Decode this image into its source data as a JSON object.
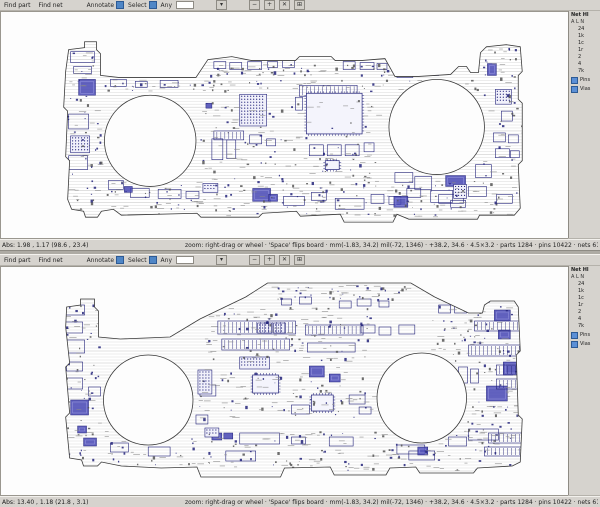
{
  "colors": {
    "toolbar_bg": "#d6d3ce",
    "canvas_bg": "#fdfdfd",
    "accent_blue": "#4f86c6",
    "component_navy": "#23237a",
    "component_fill": "#4646b4",
    "hatch": "#dadada",
    "hatch_dark": "#c2c2c2",
    "outline": "#3a3a3a",
    "speckle_gray": "#555555",
    "dash_gray": "#8a8a8a"
  },
  "windows": [
    {
      "toolbar": {
        "find_part": "Find part",
        "find_net": "Find net",
        "annotate_label": "Annotate",
        "select_label": "Select",
        "any_label": "Any",
        "search_value": "",
        "buttons": [
          {
            "glyph": "▾"
          },
          {
            "glyph": "−"
          },
          {
            "glyph": "+"
          },
          {
            "glyph": "✕"
          },
          {
            "glyph": "⊞"
          }
        ]
      },
      "sidebar": {
        "title": "Net  Hl",
        "sub": "A L N",
        "counts": [
          "24",
          "1k",
          "1c",
          "1r",
          "2",
          "4",
          "7k"
        ],
        "checks": [
          {
            "label": "Pins"
          },
          {
            "label": "Vias"
          }
        ]
      },
      "status": {
        "left": "Abs: 1.98 , 1.17  (98.6 , 23.4)",
        "message": "zoom: right-drag or wheel · 'Space' flips board · mm(-1.83, 34.2)  mil(-72, 1346) · +38.2, 34.6 · 4.5×3.2 · parts 1284 · pins 10422 · nets 612 · 60 fps"
      },
      "board": {
        "id": "board-top",
        "side_label": "top",
        "viewbox": "0 0 570 228",
        "seed": 13,
        "outline": "M68,38 L84,36 84,30 96,30 96,38 100,42 100,64 118,66 196,66 208,48 232,45 252,49 296,49 300,45 332,45 336,49 362,49 386,47 396,65 420,65 452,63 460,55 468,55 472,61 480,61 482,41 488,35 508,33 522,35 524,60 520,64 520,88 524,92 524,150 520,154 522,198 516,205 481,205 479,209 410,209 398,204 394,212 345,212 341,204 301,206 297,201 263,203 259,207 201,207 197,203 121,205 113,199 101,201 97,207 85,207 83,201 71,199 67,189 69,150 65,146 67,100 63,96 65,60 Z",
        "holes": [
          [
            150,
            130,
            46
          ],
          [
            438,
            116,
            48
          ]
        ],
        "components": {
          "f": [
            [
              78,
              68,
              17,
              16
            ],
            [
              253,
              178,
              18,
              13
            ],
            [
              269,
              184,
              9,
              7
            ],
            [
              395,
              186,
              14,
              11
            ],
            [
              447,
              165,
              20,
              11
            ],
            [
              489,
              52,
              9,
              12
            ],
            [
              124,
              176,
              8,
              6
            ],
            [
              206,
              92,
              6,
              5
            ]
          ],
          "g": [
            [
              70,
              125,
              19,
              17
            ],
            [
              240,
              83,
              27,
              32
            ],
            [
              497,
              78,
              16,
              15
            ],
            [
              203,
              173,
              15,
              9
            ],
            [
              455,
              174,
              13,
              14
            ]
          ],
          "p": [
            [
              307,
              82,
              56,
              41
            ],
            [
              326,
              150,
              14,
              9
            ]
          ],
          "c": [
            [
              300,
              74,
              58,
              11
            ],
            [
              404,
              55,
              36,
              9
            ],
            [
              214,
              120,
              30,
              9
            ]
          ],
          "o": [
            [
              68,
              103,
              20,
              15
            ],
            [
              68,
              145,
              19,
              14
            ],
            [
              70,
              40,
              24,
              11
            ],
            [
              73,
              55,
              18,
              7
            ],
            [
              214,
              50,
              12,
              7
            ],
            [
              230,
              51,
              12,
              7
            ],
            [
              248,
              50,
              14,
              8
            ],
            [
              268,
              50,
              10,
              6
            ],
            [
              283,
              49,
              12,
              7
            ],
            [
              344,
              50,
              12,
              8
            ],
            [
              361,
              51,
              14,
              7
            ],
            [
              378,
              52,
              10,
              6
            ],
            [
              212,
              128,
              11,
              21
            ],
            [
              227,
              129,
              9,
              19
            ],
            [
              310,
              134,
              14,
              11
            ],
            [
              328,
              134,
              14,
              11
            ],
            [
              346,
              134,
              14,
              11
            ],
            [
              365,
              132,
              10,
              9
            ],
            [
              296,
              86,
              7,
              13
            ],
            [
              250,
              124,
              12,
              9
            ],
            [
              267,
              128,
              9,
              7
            ],
            [
              108,
              170,
              15,
              9
            ],
            [
              130,
              178,
              19,
              9
            ],
            [
              158,
              179,
              23,
              9
            ],
            [
              186,
              181,
              13,
              7
            ],
            [
              284,
              186,
              21,
              9
            ],
            [
              312,
              182,
              15,
              8
            ],
            [
              336,
              188,
              29,
              11
            ],
            [
              372,
              184,
              13,
              9
            ],
            [
              416,
              166,
              17,
              13
            ],
            [
              440,
              184,
              25,
              9
            ],
            [
              470,
              176,
              18,
              10
            ],
            [
              452,
              190,
              15,
              7
            ],
            [
              498,
              184,
              16,
              9
            ],
            [
              110,
              68,
              16,
              7
            ],
            [
              135,
              70,
              12,
              6
            ],
            [
              160,
              69,
              18,
              7
            ],
            [
              398,
              58,
              16,
              8
            ],
            [
              503,
              100,
              11,
              10
            ],
            [
              495,
              122,
              12,
              9
            ],
            [
              510,
              124,
              10,
              8
            ],
            [
              497,
              138,
              14,
              9
            ],
            [
              512,
              140,
              9,
              7
            ],
            [
              477,
              154,
              16,
              13
            ],
            [
              396,
              162,
              18,
              10
            ],
            [
              432,
              180,
              22,
              12
            ],
            [
              408,
              178,
              14,
              9
            ],
            [
              390,
              186,
              12,
              8
            ]
          ]
        },
        "speckle_bands": [
          [
            210,
            52,
            180,
            12,
            60
          ],
          [
            104,
            68,
            376,
            12,
            80
          ],
          [
            200,
            88,
            178,
            84,
            140
          ],
          [
            104,
            170,
            400,
            38,
            200
          ],
          [
            66,
            40,
            34,
            160,
            70
          ],
          [
            484,
            36,
            44,
            168,
            80
          ]
        ]
      }
    },
    {
      "toolbar": {
        "find_part": "Find part",
        "find_net": "Find net",
        "annotate_label": "Annotate",
        "select_label": "Select",
        "any_label": "Any",
        "search_value": "",
        "buttons": [
          {
            "glyph": "▾"
          },
          {
            "glyph": "−"
          },
          {
            "glyph": "+"
          },
          {
            "glyph": "✕"
          },
          {
            "glyph": "⊞"
          }
        ]
      },
      "sidebar": {
        "title": "Net  Hl",
        "sub": "A L N",
        "counts": [
          "24",
          "1k",
          "1c",
          "1r",
          "2",
          "4",
          "7k"
        ],
        "checks": [
          {
            "label": "Pins"
          },
          {
            "label": "Vias"
          }
        ]
      },
      "status": {
        "left": "Abs: 13.40 , 1.18  (21.8 , 3.1)",
        "message": "zoom: right-drag or wheel · 'Space' flips board · mm(-1.83, 34.2)  mil(-72, 1346) · +38.2, 34.6 · 4.5×3.2 · parts 1284 · pins 10422 · nets 612 · 60 fps"
      },
      "board": {
        "id": "board-bottom",
        "side_label": "bottom",
        "viewbox": "0 0 570 228",
        "seed": 29,
        "outline": "M66,40 L80,38 80,32 94,32 94,40 98,44 98,70 120,72 170,70 200,52 246,30 268,16 412,16 436,30 470,46 484,46 486,38 492,34 516,34 520,40 522,84 518,88 520,148 524,152 522,195 514,199 479,201 475,206 421,206 417,200 391,201 387,208 335,208 331,200 285,201 281,210 201,210 197,200 161,201 121,199 101,195 97,199 83,199 81,193 69,191 65,150 69,146 65,100 69,96 65,60 Z",
        "holes": [
          [
            148,
            133,
            45
          ],
          [
            423,
            131,
            45
          ]
        ],
        "components": {
          "f": [
            [
              70,
              133,
              18,
              15
            ],
            [
              77,
              159,
              9,
              7
            ],
            [
              83,
              171,
              13,
              8
            ],
            [
              496,
              43,
              16,
              11
            ],
            [
              500,
              63,
              12,
              9
            ],
            [
              505,
              95,
              17,
              13
            ],
            [
              488,
              119,
              21,
              15
            ],
            [
              310,
              99,
              15,
              11
            ],
            [
              330,
              107,
              11,
              8
            ],
            [
              212,
              166,
              10,
              7
            ],
            [
              224,
              166,
              9,
              6
            ],
            [
              419,
              180,
              10,
              8
            ],
            [
              470,
              30,
              9,
              7
            ]
          ],
          "g": [
            [
              205,
              161,
              14,
              9
            ],
            [
              198,
              103,
              14,
              24
            ],
            [
              240,
              90,
              30,
              12
            ],
            [
              258,
              56,
              14,
              10
            ],
            [
              274,
              56,
              12,
              10
            ]
          ],
          "p": [
            [
              312,
              128,
              22,
              16
            ],
            [
              253,
              108,
              26,
              18
            ]
          ],
          "c": [
            [
              218,
              54,
              78,
              13
            ],
            [
              222,
              72,
              68,
              11
            ],
            [
              306,
              58,
              58,
              10
            ],
            [
              476,
              54,
              50,
              10
            ],
            [
              470,
              78,
              56,
              11
            ],
            [
              490,
              166,
              36,
              10
            ],
            [
              486,
              180,
              40,
              9
            ],
            [
              498,
              98,
              28,
              10
            ],
            [
              498,
              112,
              28,
              10
            ]
          ],
          "o": [
            [
              62,
              38,
              22,
              10
            ],
            [
              64,
              55,
              18,
              11
            ],
            [
              60,
              73,
              24,
              13
            ],
            [
              66,
              95,
              16,
              9
            ],
            [
              62,
              111,
              20,
              11
            ],
            [
              88,
              120,
              12,
              9
            ],
            [
              440,
              38,
              12,
              8
            ],
            [
              456,
              38,
              12,
              8
            ],
            [
              460,
              100,
              9,
              16
            ],
            [
              472,
              102,
              8,
              14
            ],
            [
              200,
              118,
              16,
              11
            ],
            [
              292,
              138,
              18,
              9
            ],
            [
              350,
              128,
              16,
              9
            ],
            [
              360,
              140,
              12,
              7
            ],
            [
              110,
              176,
              18,
              9
            ],
            [
              148,
              180,
              22,
              9
            ],
            [
              240,
              166,
              40,
              11
            ],
            [
              292,
              170,
              14,
              7
            ],
            [
              330,
              170,
              24,
              9
            ],
            [
              398,
              178,
              28,
              9
            ],
            [
              450,
              170,
              18,
              9
            ],
            [
              470,
              162,
              30,
              11
            ],
            [
              196,
              148,
              12,
              9
            ],
            [
              226,
              184,
              30,
              10
            ],
            [
              410,
              184,
              26,
              9
            ],
            [
              308,
              76,
              48,
              9
            ],
            [
              362,
              58,
              14,
              8
            ],
            [
              380,
              60,
              12,
              8
            ],
            [
              400,
              58,
              16,
              9
            ],
            [
              340,
              34,
              12,
              7
            ],
            [
              358,
              32,
              14,
              7
            ],
            [
              380,
              34,
              10,
              6
            ],
            [
              300,
              30,
              12,
              7
            ],
            [
              282,
              32,
              10,
              6
            ]
          ]
        },
        "speckle_bands": [
          [
            270,
            18,
            140,
            14,
            60
          ],
          [
            204,
            40,
            170,
            55,
            130
          ],
          [
            432,
            32,
            96,
            140,
            200
          ],
          [
            100,
            164,
            420,
            40,
            200
          ],
          [
            58,
            36,
            40,
            158,
            80
          ],
          [
            194,
            100,
            180,
            52,
            100
          ]
        ]
      }
    }
  ]
}
